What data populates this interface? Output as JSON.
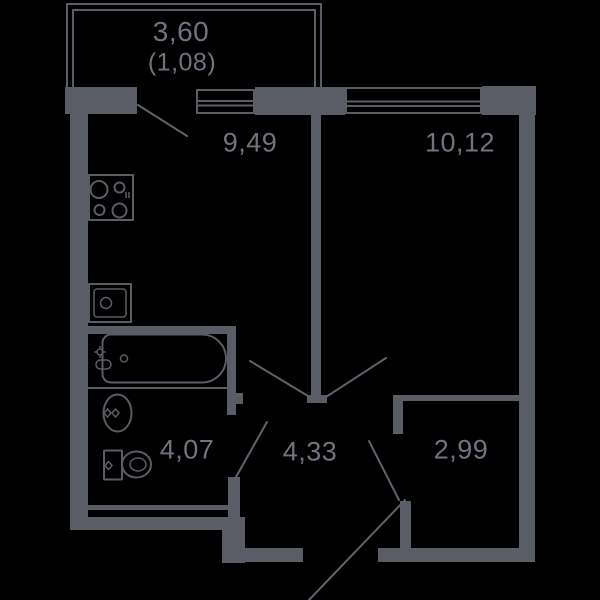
{
  "title": "1-room apartment floor plan",
  "colors": {
    "background": "#000000",
    "wall": "#5a5d66",
    "line": "#5f626c",
    "label": "#71747f"
  },
  "balcony": {
    "area": "3,60",
    "reduced_area": "(1,08)"
  },
  "rooms": {
    "kitchen": {
      "area": "9,49"
    },
    "living_room": {
      "area": "10,12"
    },
    "bathroom": {
      "area": "4,07"
    },
    "hallway": {
      "area": "4,33"
    },
    "storage": {
      "area": "2,99"
    }
  }
}
